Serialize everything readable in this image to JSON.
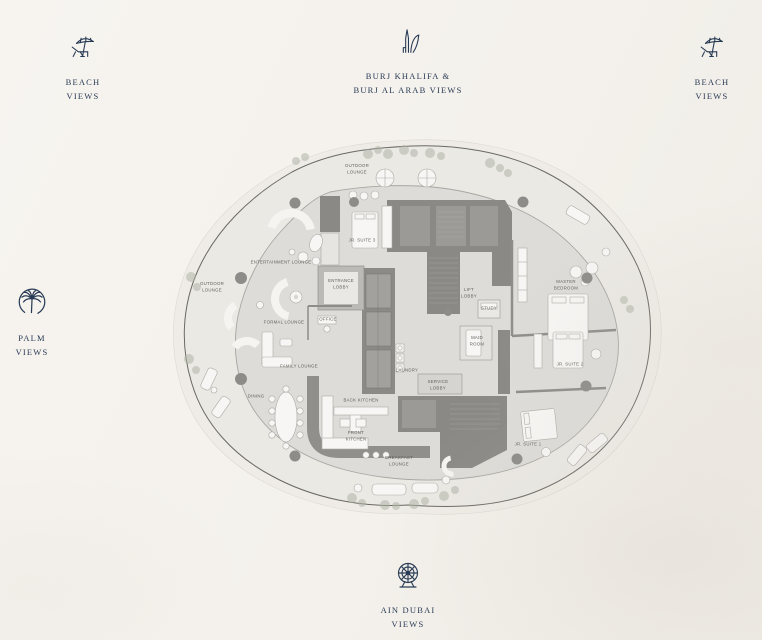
{
  "page": {
    "background": "#f4f1ec",
    "accent": "#273a54"
  },
  "view_markers": {
    "beach_top_left": {
      "label": "BEACH\nVIEWS",
      "icon": "beach-umbrella-icon"
    },
    "burj_top_center": {
      "label": "BURJ KHALIFA &\nBURJ AL ARAB VIEWS",
      "icon": "burj-towers-icon"
    },
    "beach_top_right": {
      "label": "BEACH\nVIEWS",
      "icon": "beach-umbrella-icon"
    },
    "palm_left": {
      "label": "PALM\nVIEWS",
      "icon": "palm-jumeirah-icon"
    },
    "ain_dubai_bottom": {
      "label": "AIN DUBAI\nVIEWS",
      "icon": "ferris-wheel-icon"
    }
  },
  "floorplan": {
    "rooms": [
      {
        "label": "OUTDOOR\nLOUNGE",
        "x": 357,
        "y": 170
      },
      {
        "label": "JR. SUITE 3",
        "x": 362,
        "y": 241
      },
      {
        "label": "ENTERTAINMENT LOUNGE",
        "x": 281,
        "y": 263
      },
      {
        "label": "OUTDOOR\nLOUNGE",
        "x": 212,
        "y": 288
      },
      {
        "label": "ENTRANCE\nLOBBY",
        "x": 341,
        "y": 285
      },
      {
        "label": "FORMAL LOUNGE",
        "x": 284,
        "y": 323
      },
      {
        "label": "OFFICE",
        "x": 328,
        "y": 320
      },
      {
        "label": "LIFT\nLOBBY",
        "x": 469,
        "y": 294
      },
      {
        "label": "STUDY",
        "x": 489,
        "y": 309
      },
      {
        "label": "MASTER\nBEDROOM",
        "x": 566,
        "y": 286
      },
      {
        "label": "MAID\nROOM",
        "x": 477,
        "y": 342
      },
      {
        "label": "FAMILY LOUNGE",
        "x": 299,
        "y": 367
      },
      {
        "label": "LAUNDRY",
        "x": 407,
        "y": 371
      },
      {
        "label": "SERVICE\nLOBBY",
        "x": 438,
        "y": 386
      },
      {
        "label": "JR. SUITE 2",
        "x": 570,
        "y": 365
      },
      {
        "label": "DINING",
        "x": 256,
        "y": 397
      },
      {
        "label": "BACK KITCHEN",
        "x": 361,
        "y": 401
      },
      {
        "label": "FRONT\nKITCHEN",
        "x": 356,
        "y": 437
      },
      {
        "label": "BREAKFAST\nLOUNGE",
        "x": 399,
        "y": 462
      },
      {
        "label": "JR. SUITE 1",
        "x": 528,
        "y": 445
      }
    ]
  }
}
